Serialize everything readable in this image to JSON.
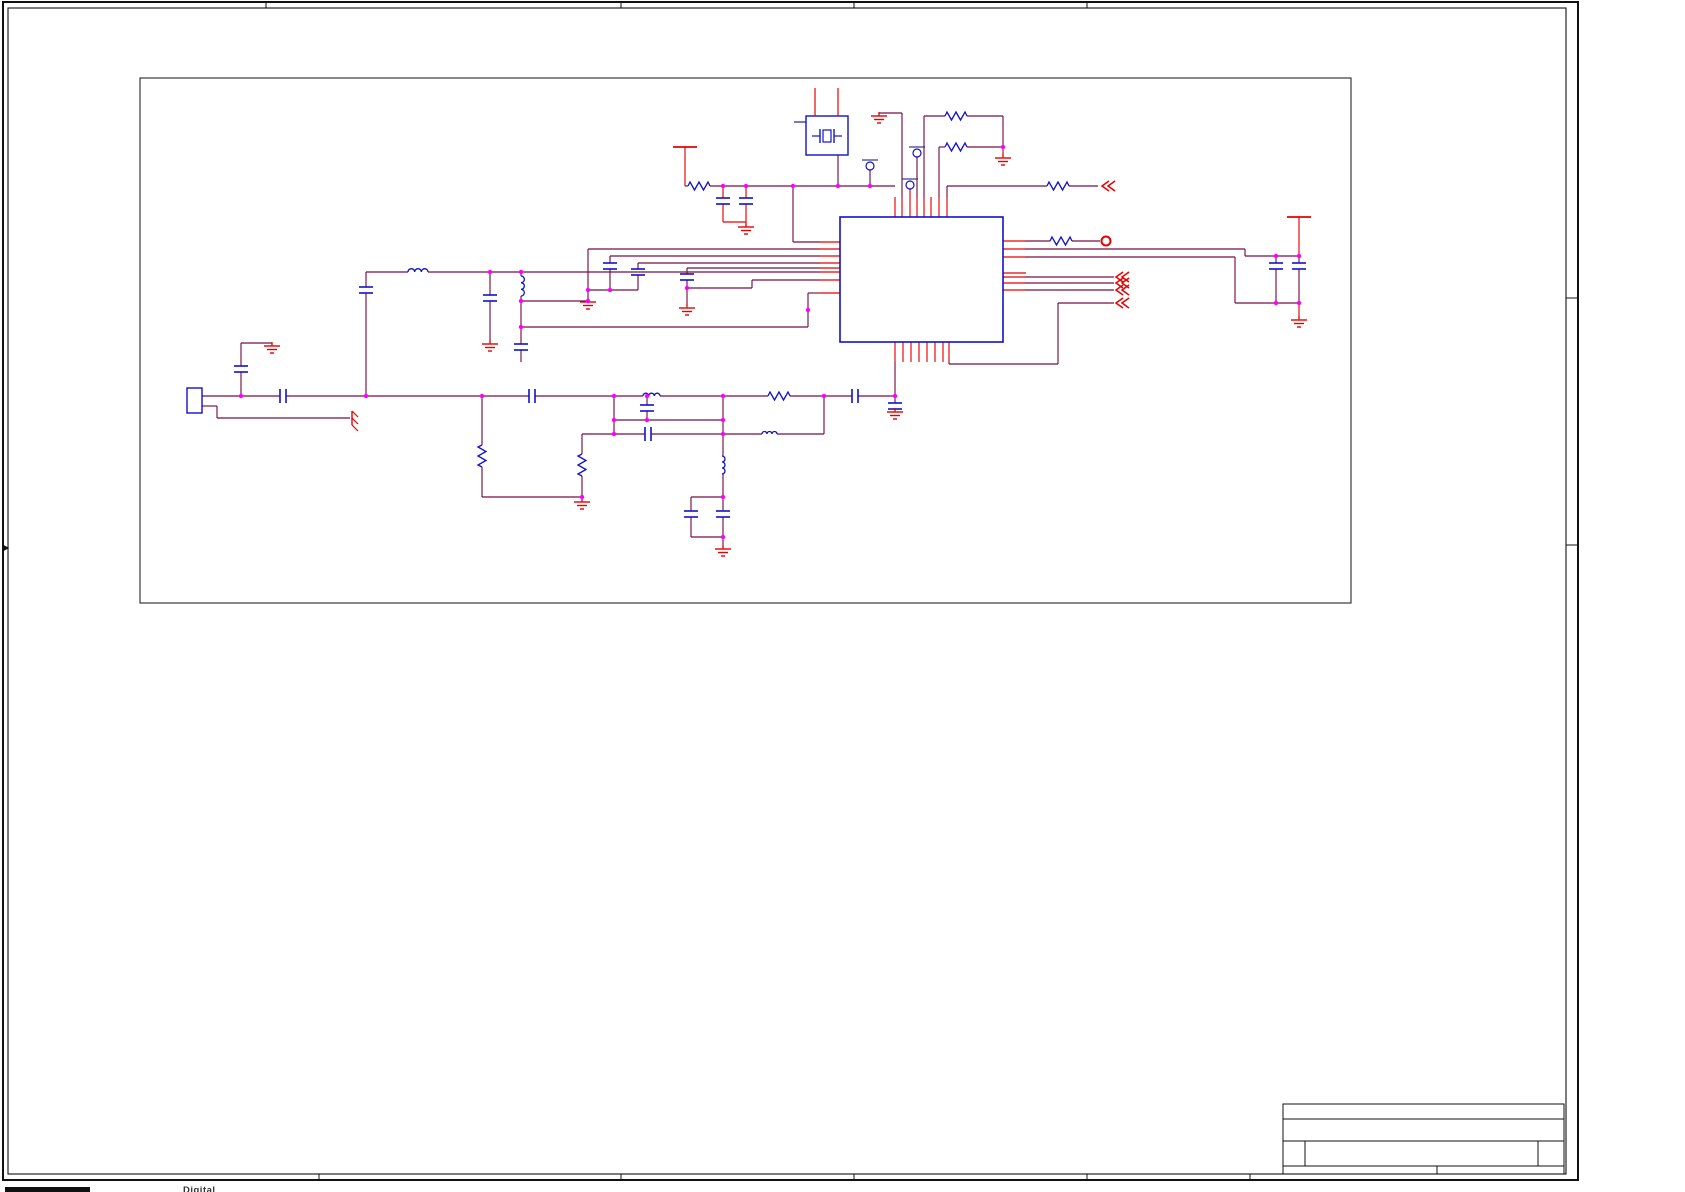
{
  "footer": {
    "fragment": "Digital"
  },
  "colors": {
    "wire": "#770F44",
    "pin_red": "#E80000",
    "component_blue": "#1111C8",
    "junction_magenta": "#FF00FF",
    "frame_black": "#111111"
  },
  "frame": {
    "outer": [
      3,
      2,
      1575,
      1178
    ],
    "inner": [
      8,
      8,
      1558,
      1166
    ],
    "top_ticks_x": [
      266,
      621,
      854,
      1087
    ],
    "bottom_ticks_x": [
      319,
      621,
      854,
      1087,
      1250
    ],
    "right_ticks_y": [
      298,
      545
    ],
    "left_arrow_y": 548
  },
  "title_block": {
    "x": 1283,
    "y": 1104,
    "right": 1564,
    "bottom": 1174,
    "hlines": [
      1119,
      1141,
      1166
    ],
    "row3_verticals": [
      1305,
      1538
    ],
    "row4_verticals": [
      1437
    ]
  },
  "schematic": {
    "border": [
      140,
      78,
      1211,
      525
    ],
    "ic": [
      840,
      217,
      163,
      125
    ],
    "crystal": {
      "box": [
        806,
        116,
        42,
        39
      ],
      "stubs": [
        [
          815,
          88,
          815,
          116
        ],
        [
          838,
          88,
          838,
          116
        ]
      ],
      "lead": [
        794,
        122,
        806,
        122
      ]
    },
    "connector": [
      187,
      388,
      15,
      25
    ],
    "wires": [
      [
        685,
        186,
        688,
        186
      ],
      [
        710,
        186,
        895,
        186
      ],
      [
        793,
        186,
        793,
        242
      ],
      [
        793,
        242,
        820,
        242
      ],
      [
        838,
        155,
        838,
        186
      ],
      [
        870,
        170,
        870,
        186
      ],
      [
        902,
        113,
        902,
        197
      ],
      [
        902,
        113,
        879,
        113
      ],
      [
        917,
        157,
        917,
        197
      ],
      [
        924,
        116,
        924,
        197
      ],
      [
        924,
        116,
        945,
        116
      ],
      [
        967,
        116,
        1003,
        116
      ],
      [
        1003,
        116,
        1003,
        147
      ],
      [
        939,
        147,
        939,
        197
      ],
      [
        939,
        147,
        945,
        147
      ],
      [
        967,
        147,
        1003,
        147
      ],
      [
        947,
        186,
        947,
        197
      ],
      [
        947,
        186,
        1047,
        186
      ],
      [
        1069,
        186,
        1098,
        186
      ],
      [
        588,
        249,
        820,
        249
      ],
      [
        588,
        249,
        588,
        301
      ],
      [
        521,
        301,
        588,
        301
      ],
      [
        610,
        256,
        820,
        256
      ],
      [
        610,
        256,
        610,
        263
      ],
      [
        610,
        269,
        610,
        290
      ],
      [
        610,
        290,
        588,
        290
      ],
      [
        638,
        263,
        820,
        263
      ],
      [
        638,
        263,
        638,
        269
      ],
      [
        638,
        275,
        638,
        290
      ],
      [
        638,
        290,
        610,
        290
      ],
      [
        687,
        268,
        820,
        268
      ],
      [
        687,
        268,
        687,
        274
      ],
      [
        687,
        280,
        687,
        306
      ],
      [
        752,
        280,
        820,
        280
      ],
      [
        752,
        280,
        752,
        288
      ],
      [
        752,
        288,
        687,
        288
      ],
      [
        366,
        272,
        408,
        272
      ],
      [
        428,
        272,
        820,
        272
      ],
      [
        808,
        293,
        820,
        293
      ],
      [
        808,
        293,
        808,
        327
      ],
      [
        521,
        327,
        808,
        327
      ],
      [
        490,
        272,
        490,
        295
      ],
      [
        490,
        301,
        490,
        343
      ],
      [
        521,
        272,
        521,
        276
      ],
      [
        521,
        296,
        521,
        344
      ],
      [
        521,
        350,
        521,
        362
      ],
      [
        366,
        272,
        366,
        287
      ],
      [
        366,
        293,
        366,
        396
      ],
      [
        202,
        396,
        280,
        396
      ],
      [
        286,
        396,
        529,
        396
      ],
      [
        535,
        396,
        643,
        396
      ],
      [
        660,
        396,
        768,
        396
      ],
      [
        790,
        396,
        852,
        396
      ],
      [
        858,
        396,
        895,
        396
      ],
      [
        241,
        396,
        241,
        372
      ],
      [
        241,
        366,
        241,
        343
      ],
      [
        241,
        343,
        272,
        343
      ],
      [
        272,
        343,
        272,
        345
      ],
      [
        202,
        406,
        217,
        406
      ],
      [
        217,
        406,
        217,
        418
      ],
      [
        217,
        418,
        350,
        418
      ],
      [
        482,
        396,
        482,
        445
      ],
      [
        482,
        467,
        482,
        497
      ],
      [
        482,
        497,
        582,
        497
      ],
      [
        582,
        497,
        582,
        501
      ],
      [
        582,
        434,
        582,
        454
      ],
      [
        582,
        476,
        582,
        497
      ],
      [
        582,
        434,
        614,
        434
      ],
      [
        614,
        396,
        614,
        434
      ],
      [
        723,
        396,
        723,
        434
      ],
      [
        614,
        420,
        723,
        420
      ],
      [
        647,
        396,
        647,
        405
      ],
      [
        647,
        411,
        647,
        420
      ],
      [
        614,
        434,
        645,
        434
      ],
      [
        651,
        434,
        762,
        434
      ],
      [
        777,
        434,
        824,
        434
      ],
      [
        824,
        434,
        824,
        396
      ],
      [
        723,
        434,
        723,
        456
      ],
      [
        723,
        474,
        723,
        497
      ],
      [
        691,
        497,
        723,
        497
      ],
      [
        691,
        497,
        691,
        511
      ],
      [
        691,
        517,
        691,
        537
      ],
      [
        691,
        537,
        723,
        537
      ],
      [
        723,
        497,
        723,
        511
      ],
      [
        723,
        517,
        723,
        537
      ],
      [
        723,
        537,
        723,
        548
      ],
      [
        1025,
        249,
        1245,
        249
      ],
      [
        1245,
        249,
        1245,
        256
      ],
      [
        1245,
        256,
        1299,
        256
      ],
      [
        1025,
        257,
        1235,
        257
      ],
      [
        1235,
        257,
        1235,
        303
      ],
      [
        1235,
        303,
        1299,
        303
      ],
      [
        1276,
        256,
        1276,
        263
      ],
      [
        1276,
        269,
        1276,
        303
      ],
      [
        1299,
        256,
        1299,
        263
      ],
      [
        1299,
        269,
        1299,
        303
      ],
      [
        1025,
        241,
        1050,
        241
      ],
      [
        1072,
        241,
        1100,
        241
      ],
      [
        1025,
        277,
        1114,
        277
      ],
      [
        1025,
        283,
        1114,
        283
      ],
      [
        1025,
        290,
        1114,
        290
      ],
      [
        949,
        362,
        949,
        364
      ],
      [
        949,
        364,
        1058,
        364
      ],
      [
        1058,
        364,
        1058,
        303
      ],
      [
        1058,
        303,
        1114,
        303
      ],
      [
        895,
        362,
        895,
        403
      ],
      [
        895,
        409,
        895,
        411
      ]
    ],
    "red_lines": [
      [
        895,
        197,
        895,
        217
      ],
      [
        902,
        197,
        902,
        217
      ],
      [
        910,
        189,
        910,
        217
      ],
      [
        917,
        197,
        917,
        217
      ],
      [
        924,
        197,
        924,
        217
      ],
      [
        931,
        197,
        931,
        217
      ],
      [
        939,
        197,
        939,
        217
      ],
      [
        947,
        197,
        947,
        217
      ],
      [
        820,
        242,
        840,
        242
      ],
      [
        820,
        249,
        840,
        249
      ],
      [
        820,
        256,
        840,
        256
      ],
      [
        820,
        263,
        840,
        263
      ],
      [
        820,
        268,
        840,
        268
      ],
      [
        820,
        272,
        840,
        272
      ],
      [
        820,
        280,
        840,
        280
      ],
      [
        820,
        293,
        840,
        293
      ],
      [
        1003,
        241,
        1025,
        241
      ],
      [
        1003,
        249,
        1025,
        249
      ],
      [
        1003,
        257,
        1025,
        257
      ],
      [
        1003,
        273,
        1026,
        273
      ],
      [
        1003,
        277,
        1025,
        277
      ],
      [
        1003,
        283,
        1025,
        283
      ],
      [
        1003,
        290,
        1025,
        290
      ],
      [
        895,
        342,
        895,
        362
      ],
      [
        903,
        342,
        903,
        362
      ],
      [
        911,
        342,
        911,
        362
      ],
      [
        919,
        342,
        919,
        362
      ],
      [
        927,
        342,
        927,
        362
      ],
      [
        935,
        342,
        935,
        362
      ],
      [
        943,
        342,
        943,
        362
      ],
      [
        949,
        342,
        949,
        362
      ],
      [
        685,
        147,
        685,
        186
      ],
      [
        723,
        186,
        723,
        198
      ],
      [
        746,
        186,
        746,
        198
      ],
      [
        723,
        204,
        723,
        222
      ],
      [
        746,
        204,
        746,
        222
      ],
      [
        723,
        222,
        746,
        222
      ],
      [
        746,
        222,
        746,
        226
      ],
      [
        879,
        113,
        879,
        115
      ],
      [
        1003,
        147,
        1003,
        157
      ],
      [
        1299,
        217,
        1299,
        256
      ],
      [
        1299,
        303,
        1299,
        319
      ]
    ],
    "resistors": [
      [
        945,
        116,
        "h"
      ],
      [
        945,
        147,
        "h"
      ],
      [
        1047,
        186,
        "h"
      ],
      [
        1050,
        241,
        "h"
      ],
      [
        768,
        396,
        "h"
      ],
      [
        688,
        186,
        "h"
      ],
      [
        482,
        445,
        "v"
      ],
      [
        582,
        454,
        "v"
      ]
    ],
    "inductors": [
      [
        408,
        272,
        "h",
        20
      ],
      [
        643,
        396,
        "h",
        17
      ],
      [
        762,
        434,
        "h",
        15
      ],
      [
        521,
        276,
        "v",
        20
      ],
      [
        722,
        456,
        "v",
        18
      ]
    ],
    "capacitors": [
      [
        723,
        201,
        "v"
      ],
      [
        746,
        201,
        "v"
      ],
      [
        610,
        266,
        "v"
      ],
      [
        638,
        272,
        "v"
      ],
      [
        687,
        277,
        "v"
      ],
      [
        490,
        298,
        "v"
      ],
      [
        521,
        347,
        "v"
      ],
      [
        366,
        290,
        "v"
      ],
      [
        241,
        369,
        "v"
      ],
      [
        283,
        396,
        "h"
      ],
      [
        532,
        396,
        "h"
      ],
      [
        855,
        396,
        "h"
      ],
      [
        647,
        408,
        "v"
      ],
      [
        648,
        434,
        "h"
      ],
      [
        691,
        514,
        "v"
      ],
      [
        723,
        514,
        "v"
      ],
      [
        1276,
        266,
        "v"
      ],
      [
        1299,
        266,
        "v"
      ],
      [
        895,
        406,
        "v"
      ]
    ],
    "grounds": [
      [
        746,
        227
      ],
      [
        879,
        116
      ],
      [
        1003,
        158
      ],
      [
        588,
        302
      ],
      [
        687,
        308
      ],
      [
        490,
        344
      ],
      [
        272,
        346
      ],
      [
        582,
        502
      ],
      [
        723,
        549
      ],
      [
        895,
        412
      ],
      [
        1299,
        320
      ]
    ],
    "chassis_grounds": [
      [
        352,
        418
      ]
    ],
    "power_bars": [
      [
        685,
        147
      ],
      [
        1299,
        217
      ]
    ],
    "nc_circles": [
      [
        870,
        166
      ],
      [
        910,
        185
      ],
      [
        917,
        153
      ]
    ],
    "ports_chevron": [
      [
        1102,
        186
      ],
      [
        1116,
        277
      ],
      [
        1116,
        283
      ],
      [
        1116,
        290
      ],
      [
        1116,
        303
      ]
    ],
    "ports_ring": [
      [
        1106,
        241
      ]
    ],
    "junctions": [
      [
        723,
        186
      ],
      [
        746,
        186
      ],
      [
        793,
        186
      ],
      [
        838,
        186
      ],
      [
        870,
        186
      ],
      [
        1003,
        147
      ],
      [
        490,
        272
      ],
      [
        521,
        272
      ],
      [
        588,
        290
      ],
      [
        610,
        290
      ],
      [
        588,
        301
      ],
      [
        521,
        301
      ],
      [
        521,
        327
      ],
      [
        687,
        288
      ],
      [
        808,
        310
      ],
      [
        241,
        396
      ],
      [
        366,
        396
      ],
      [
        482,
        396
      ],
      [
        614,
        396
      ],
      [
        647,
        396
      ],
      [
        723,
        396
      ],
      [
        824,
        396
      ],
      [
        895,
        396
      ],
      [
        614,
        420
      ],
      [
        647,
        420
      ],
      [
        723,
        420
      ],
      [
        614,
        434
      ],
      [
        723,
        434
      ],
      [
        582,
        497
      ],
      [
        723,
        497
      ],
      [
        723,
        537
      ],
      [
        1276,
        256
      ],
      [
        1299,
        256
      ],
      [
        1276,
        303
      ],
      [
        1299,
        303
      ]
    ]
  }
}
